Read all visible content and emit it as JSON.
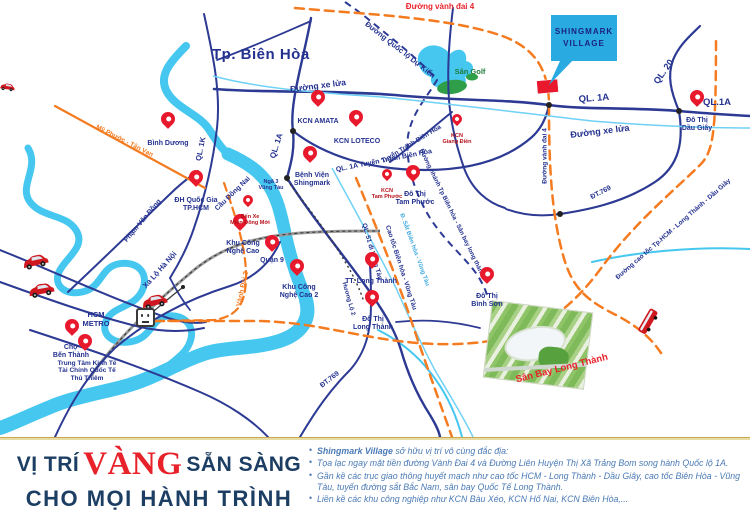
{
  "map": {
    "city": "Tp. Biên Hòa",
    "project": {
      "name": "SHINGMARK\nVILLAGE"
    },
    "metro": "HCM\nMETRO",
    "pins": [
      {
        "label": "Bình Dương"
      },
      {
        "label": "KCN AMATA"
      },
      {
        "label": "KCN LOTECO"
      },
      {
        "label": "Bệnh Viện\nShingmark"
      },
      {
        "label": "ĐH Quốc Gia\nTP.HCM"
      },
      {
        "label": "Khu Công\nNghệ Cao"
      },
      {
        "label": "Quận 9"
      },
      {
        "label": "Khu Công\nNghệ Cao 2"
      },
      {
        "label": "Đô Thị\nTam Phước"
      },
      {
        "label": "TT. Long Thành"
      },
      {
        "label": "Đô Thị\nLong Thành"
      },
      {
        "label": "Đô Thị\nBình Sơn"
      },
      {
        "label": "Đô Thị\nDầu Giây"
      },
      {
        "label": "Chợ\nBến Thành"
      },
      {
        "label": "Trung Tâm Kinh Tế\nTài Chính Quốc Tế\nThủ Thiêm"
      }
    ],
    "small_pins": [
      {
        "label": "Bến Xe\nMiền Đông Mới"
      },
      {
        "label": "KCN\nTam Phước"
      },
      {
        "label": "KCN\nGiang Điền"
      }
    ],
    "road_labels": [
      {
        "text": "Đường vành đai 4"
      },
      {
        "text": "QL. 1A"
      },
      {
        "text": "QL. 1K"
      },
      {
        "text": "QL. 1A"
      },
      {
        "text": "QL.1A"
      },
      {
        "text": "QL. 20"
      },
      {
        "text": "Đường xe lửa"
      },
      {
        "text": "Đường xe lửa"
      },
      {
        "text": "Đường Quốc lộ Dự Kiến"
      },
      {
        "text": "Mỹ Phước - Tân Vạn"
      },
      {
        "text": "QL. 1A Tuyến Tránh Biên Hòa"
      },
      {
        "text": "Tuyến Tránh Biên Hòa"
      },
      {
        "text": "Cầu Đồng Nai"
      },
      {
        "text": "Ngã 3\nVũng Tàu"
      },
      {
        "text": "Phạm Văn Đồng"
      },
      {
        "text": "Xa Lộ Hà Nội"
      },
      {
        "text": "Vành Đai 3"
      },
      {
        "text": "QL. 51 đi Vũng Tàu"
      },
      {
        "text": "Cao tốc Biên hòa - Vũng Tàu"
      },
      {
        "text": "Đ. Sắt Biên hòa - Vũng Tàu"
      },
      {
        "text": "Đường nhánh Tp Biên hòa - Sân bay long thành"
      },
      {
        "text": "ĐT.769"
      },
      {
        "text": "ĐT.769"
      },
      {
        "text": "Đường cao tốc Tp.HCM - Long Thành - Dầu Giây"
      },
      {
        "text": "Hương Lộ 2"
      },
      {
        "text": "Đường vành đai 4"
      },
      {
        "text": "Sân Golf"
      },
      {
        "text": "Sân Bay Long Thành"
      }
    ]
  },
  "footer": {
    "title": {
      "part1": "VỊ TRÍ",
      "part2": "VÀNG",
      "part3": "SẴN SÀNG",
      "line2": "CHO MỌI HÀNH TRÌNH"
    },
    "bullets": [
      {
        "lead": "Shingmark Village",
        "text": " sở hữu vị trí vô cùng đắc địa:"
      },
      {
        "text": "Tọa lạc ngay mặt tiền đường Vành Đai 4 và Đường Liên Huyện Thị Xã Trảng Bom song hành Quốc lộ 1A."
      },
      {
        "text": "Gần kề các trục giao thông huyết mạch như cao tốc HCM - Long Thành - Dầu Giây, cao tốc Biên Hòa - Vũng Tàu, tuyến đường sắt Bắc Nam, sân bay Quốc Tế Long Thành."
      },
      {
        "text": "Liền kề các khu công nghiệp như KCN Bàu Xéo, KCN Hố Nai, KCN Biên Hòa,..."
      }
    ]
  },
  "colors": {
    "pin_red": "#e8192c",
    "road_navy": "#2d3a94",
    "river_blue": "#45c7f0",
    "railway_cyan": "#6fd1f5",
    "highway_orange": "#f47b20",
    "callout_blue": "#29abe2",
    "title_navy": "#1d3e63",
    "title_red": "#e8222a",
    "bullet_blue": "#4a7ab5",
    "gold_line": "#c9a94e"
  }
}
